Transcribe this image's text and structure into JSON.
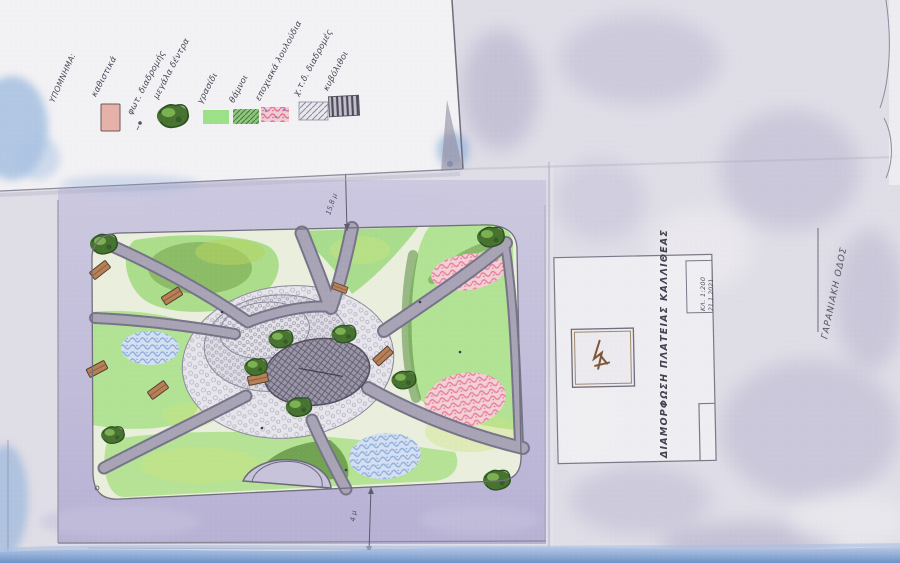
{
  "legend": {
    "heading": "ΥΠΟΜΝΗΜΑ:",
    "items": [
      {
        "label": "καθιστικά",
        "swatch": "bench-pink-rectangle"
      },
      {
        "label": "φωτ. διαδρομής",
        "swatch": "small-dot"
      },
      {
        "label": "μεγάλα δέντρα",
        "swatch": "dark-green-tree-blob"
      },
      {
        "label": "γρασίδι",
        "swatch": "light-green-rectangle"
      },
      {
        "label": "θάμνοι",
        "swatch": "green-hatched-rectangle"
      },
      {
        "label": "εποχιακά λουλούδια",
        "swatch": "pink-blue-scribble-rectangle"
      },
      {
        "label": "χ.τ.δ. διαδρομές",
        "swatch": "light-grey-diagonal-hatch"
      },
      {
        "label": "κυβόλιθοι",
        "swatch": "dark-grey-vertical-hatch"
      }
    ]
  },
  "title_block": {
    "title": "ΔΙΑΜΟΡΦΩΣΗ ΠΛΑΤΕΙΑΣ ΚΑΛΛΙΘΕΑΣ",
    "scale": "ΚΛ. 1:200",
    "date": "21.1.2021"
  },
  "annotations": {
    "street": "ΓΑΡΑΝΙΑΚΗ ΟΔΟΣ",
    "dim_top": "15,8 μ",
    "dim_bottom": "4 μ"
  },
  "colors": {
    "paper": "#dfdde6",
    "legend_sheet": "#f2f1f4",
    "sidewalk": "#bcb7d6",
    "lawn": "#aedd8e",
    "shrub_dark": "#5c8e3e",
    "path_grey": "#a19db0",
    "flower_pink": "#e2738f",
    "flower_blue": "#7fa3d8",
    "tree_green": "#47722f",
    "bench_brown": "#b97f57",
    "water_blue": "#7da2d2",
    "pencil": "#6a6775"
  }
}
